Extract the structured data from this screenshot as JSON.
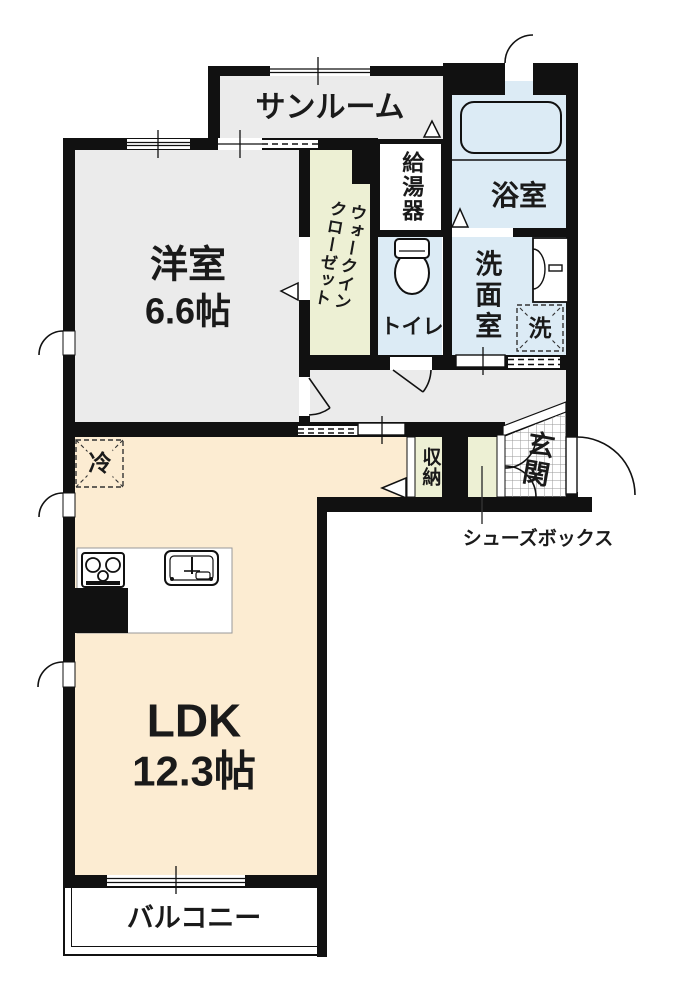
{
  "rooms": {
    "sunroom": {
      "label": "サンルーム"
    },
    "western_room": {
      "label": "洋室",
      "size": "6.6帖"
    },
    "walk_in_closet": {
      "label_line1": "ウォークイン",
      "label_line2": "クローゼット"
    },
    "water_heater": {
      "label": "給湯器"
    },
    "bathroom": {
      "label": "浴室"
    },
    "toilet": {
      "label": "トイレ"
    },
    "washroom": {
      "label": "洗面室"
    },
    "laundry_space": {
      "label": "洗"
    },
    "refrigerator_space": {
      "label": "冷"
    },
    "storage": {
      "label": "収納"
    },
    "entrance": {
      "label": "玄関"
    },
    "shoe_box": {
      "label": "シューズボックス"
    },
    "ldk": {
      "label": "LDK",
      "size": "12.3帖"
    },
    "balcony": {
      "label": "バルコニー"
    }
  },
  "colors": {
    "wall": "#111111",
    "room_gray": "#ebebeb",
    "wet_area_blue": "#dcebf5",
    "closet_green": "#edf0d4",
    "ldk_beige": "#fcecd2",
    "tile_line": "#999999"
  }
}
